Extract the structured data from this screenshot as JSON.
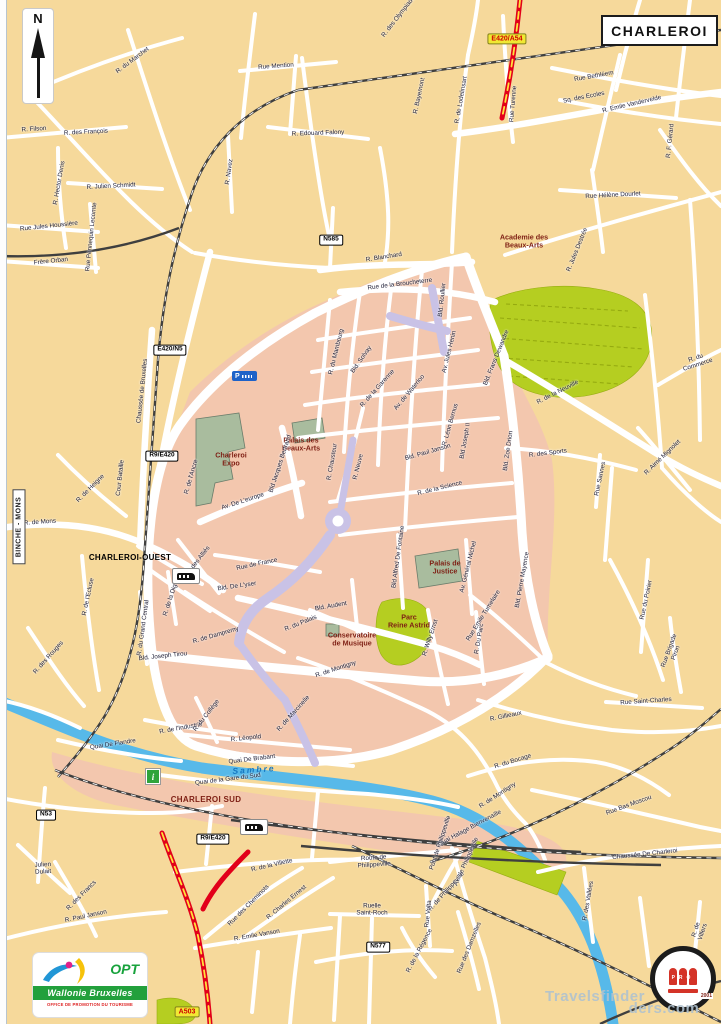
{
  "map": {
    "title": "CHARLEROI",
    "compass": "N",
    "region_tab": "BINCHE - MONS",
    "colors": {
      "land": "#F6D99B",
      "urban": "#F3C7AE",
      "park": "#B5CE21",
      "building": "#A9BC9E",
      "water": "#57B9E9",
      "motorway": "#E2001A",
      "tram": "#C9C2E6",
      "ref_yellow": "#F1E833"
    },
    "icons": {
      "parking": "P",
      "info": "i"
    },
    "labels": [
      {
        "t": "E420/A54",
        "x": 507,
        "y": 39,
        "r": 0,
        "c": "refy"
      },
      {
        "t": "A503",
        "x": 187,
        "y": 1012,
        "r": 0,
        "c": "refy"
      },
      {
        "t": "N585",
        "x": 331,
        "y": 240,
        "r": 0,
        "c": "ref"
      },
      {
        "t": "E420/N5",
        "x": 170,
        "y": 350,
        "r": 0,
        "c": "ref"
      },
      {
        "t": "R9/E420",
        "x": 162,
        "y": 456,
        "r": 0,
        "c": "ref"
      },
      {
        "t": "R9/E420",
        "x": 213,
        "y": 839,
        "r": 0,
        "c": "ref"
      },
      {
        "t": "N53",
        "x": 46,
        "y": 815,
        "r": 0,
        "c": "ref"
      },
      {
        "t": "N577",
        "x": 378,
        "y": 947,
        "r": 0,
        "c": "ref"
      },
      {
        "t": "CHARLEROI-OUEST",
        "x": 130,
        "y": 558,
        "r": 0,
        "c": "sta"
      },
      {
        "t": "CHARLEROI SUD",
        "x": 206,
        "y": 800,
        "r": 0,
        "c": "sta2"
      },
      {
        "t": "Academie des\nBeaux-Arts",
        "x": 524,
        "y": 241,
        "r": 0,
        "c": "poi"
      },
      {
        "t": "Palais des\nBeaux-Arts",
        "x": 301,
        "y": 444,
        "r": 0,
        "c": "poi"
      },
      {
        "t": "Charleroi\nExpo",
        "x": 231,
        "y": 459,
        "r": 0,
        "c": "poi"
      },
      {
        "t": "Palais de\nJustice",
        "x": 445,
        "y": 567,
        "r": 0,
        "c": "poi"
      },
      {
        "t": "Parc\nReine Astrid",
        "x": 409,
        "y": 621,
        "r": 0,
        "c": "poi"
      },
      {
        "t": "Conservatoire\nde Musique",
        "x": 352,
        "y": 639,
        "r": 0,
        "c": "poi"
      },
      {
        "t": "Sambre",
        "x": 254,
        "y": 770,
        "r": -4,
        "c": "river"
      },
      {
        "t": "Travelsfinder",
        "x": 595,
        "y": 997,
        "r": 0,
        "c": "wm"
      },
      {
        "t": "ders.com",
        "x": 664,
        "y": 1009,
        "r": 0,
        "c": "wm"
      },
      {
        "t": "R. des Olympiades",
        "x": 400,
        "y": 16,
        "r": -52,
        "c": "st"
      },
      {
        "t": "R. de Lodelinsart",
        "x": 462,
        "y": 100,
        "r": -80,
        "c": "st"
      },
      {
        "t": "Rue Turenne",
        "x": 514,
        "y": 104,
        "r": -85,
        "c": "st"
      },
      {
        "t": "R. Bayemont",
        "x": 420,
        "y": 96,
        "r": -78,
        "c": "st"
      },
      {
        "t": "Rue Mention",
        "x": 276,
        "y": 67,
        "r": -4,
        "c": "st"
      },
      {
        "t": "R. du Marchet",
        "x": 133,
        "y": 61,
        "r": -37,
        "c": "st"
      },
      {
        "t": "R. Edouard Falony",
        "x": 318,
        "y": 134,
        "r": -2,
        "c": "st"
      },
      {
        "t": "R. Navez",
        "x": 230,
        "y": 172,
        "r": -82,
        "c": "st"
      },
      {
        "t": "Rue Bethléem",
        "x": 594,
        "y": 77,
        "r": -10,
        "c": "st"
      },
      {
        "t": "R. Emile Vandervelde",
        "x": 632,
        "y": 105,
        "r": -13,
        "c": "st"
      },
      {
        "t": "Sq. des Ecoles",
        "x": 584,
        "y": 98,
        "r": -11,
        "c": "st"
      },
      {
        "t": "R. Filson",
        "x": 34,
        "y": 130,
        "r": -4,
        "c": "st"
      },
      {
        "t": "R. des François",
        "x": 86,
        "y": 133,
        "r": -3,
        "c": "st"
      },
      {
        "t": "R. Hector Denis",
        "x": 60,
        "y": 183,
        "r": -80,
        "c": "st"
      },
      {
        "t": "R. Julien Schmidt",
        "x": 111,
        "y": 187,
        "r": -3,
        "c": "st"
      },
      {
        "t": "Rue Jules Houssière",
        "x": 49,
        "y": 227,
        "r": -6,
        "c": "st"
      },
      {
        "t": "Frère Orban",
        "x": 51,
        "y": 262,
        "r": -6,
        "c": "st"
      },
      {
        "t": "Rue Pennequin Lecomte",
        "x": 92,
        "y": 237,
        "r": -84,
        "c": "st"
      },
      {
        "t": "Rue Hélène Dourlet",
        "x": 613,
        "y": 196,
        "r": -3,
        "c": "st"
      },
      {
        "t": "R. F. Gérard",
        "x": 671,
        "y": 141,
        "r": -84,
        "c": "st"
      },
      {
        "t": "R. Jules Destrée",
        "x": 578,
        "y": 250,
        "r": -68,
        "c": "st"
      },
      {
        "t": "R. Blanchard",
        "x": 384,
        "y": 258,
        "r": -9,
        "c": "st"
      },
      {
        "t": "Rue de la Broucheterre",
        "x": 400,
        "y": 285,
        "r": -7,
        "c": "st"
      },
      {
        "t": "Bld. Roullier",
        "x": 443,
        "y": 300,
        "r": -84,
        "c": "st"
      },
      {
        "t": "R. du Mambourg",
        "x": 337,
        "y": 352,
        "r": -76,
        "c": "st"
      },
      {
        "t": "Bld. Solvay",
        "x": 362,
        "y": 360,
        "r": -55,
        "c": "st"
      },
      {
        "t": "R. de la Garenne",
        "x": 378,
        "y": 389,
        "r": -48,
        "c": "st"
      },
      {
        "t": "Av. de Waterloo",
        "x": 410,
        "y": 393,
        "r": -50,
        "c": "st"
      },
      {
        "t": "Av. Jules Henin",
        "x": 450,
        "y": 352,
        "r": -76,
        "c": "st"
      },
      {
        "t": "Bld. Frans Dewandre",
        "x": 497,
        "y": 358,
        "r": -68,
        "c": "st"
      },
      {
        "t": "Bld. Zoe Drion",
        "x": 509,
        "y": 451,
        "r": -82,
        "c": "st"
      },
      {
        "t": "R. Léon Bernus",
        "x": 451,
        "y": 425,
        "r": -74,
        "c": "st"
      },
      {
        "t": "Bld. Paul Janson",
        "x": 428,
        "y": 453,
        "r": -16,
        "c": "st"
      },
      {
        "t": "Bld Joseph II",
        "x": 466,
        "y": 441,
        "r": -80,
        "c": "st"
      },
      {
        "t": "R. de la Science",
        "x": 440,
        "y": 489,
        "r": -14,
        "c": "st"
      },
      {
        "t": "Chaussée de Bruxelles",
        "x": 143,
        "y": 391,
        "r": -84,
        "c": "st"
      },
      {
        "t": "R. de Heigne",
        "x": 91,
        "y": 489,
        "r": -45,
        "c": "st"
      },
      {
        "t": "R. de Mons",
        "x": 40,
        "y": 523,
        "r": -4,
        "c": "st"
      },
      {
        "t": "Cour Bataille",
        "x": 121,
        "y": 478,
        "r": -84,
        "c": "st"
      },
      {
        "t": "R. de l'Ecluse",
        "x": 89,
        "y": 597,
        "r": -78,
        "c": "st"
      },
      {
        "t": "Av. des Alliés",
        "x": 198,
        "y": 562,
        "r": -52,
        "c": "st"
      },
      {
        "t": "R. de la Digue",
        "x": 172,
        "y": 597,
        "r": -72,
        "c": "st"
      },
      {
        "t": "R. du Grand Central",
        "x": 144,
        "y": 628,
        "r": -82,
        "c": "st"
      },
      {
        "t": "Rue de France",
        "x": 257,
        "y": 565,
        "r": -12,
        "c": "st"
      },
      {
        "t": "Bld. De L'yser",
        "x": 237,
        "y": 587,
        "r": -8,
        "c": "st"
      },
      {
        "t": "R. de Dampremy",
        "x": 216,
        "y": 636,
        "r": -16,
        "c": "st"
      },
      {
        "t": "Bld. Joseph Tirou",
        "x": 163,
        "y": 657,
        "r": -6,
        "c": "st"
      },
      {
        "t": "Bld. Audent",
        "x": 331,
        "y": 607,
        "r": -10,
        "c": "st"
      },
      {
        "t": "R. du Palais",
        "x": 301,
        "y": 624,
        "r": -22,
        "c": "st"
      },
      {
        "t": "R. de Montigny",
        "x": 336,
        "y": 670,
        "r": -18,
        "c": "st"
      },
      {
        "t": "R. de Montigny",
        "x": 498,
        "y": 796,
        "r": -33,
        "c": "st"
      },
      {
        "t": "Av. De L'europe",
        "x": 243,
        "y": 502,
        "r": -18,
        "c": "st"
      },
      {
        "t": "Bld Jacques Bertrand",
        "x": 281,
        "y": 464,
        "r": -72,
        "c": "st"
      },
      {
        "t": "R. de l'Ancre",
        "x": 192,
        "y": 477,
        "r": -74,
        "c": "st"
      },
      {
        "t": "R. Chausteur",
        "x": 333,
        "y": 462,
        "r": -80,
        "c": "st"
      },
      {
        "t": "R. Neuve",
        "x": 359,
        "y": 467,
        "r": -76,
        "c": "st"
      },
      {
        "t": "Bld Alfred De Fontaine",
        "x": 399,
        "y": 557,
        "r": -82,
        "c": "st"
      },
      {
        "t": "Av. Général Michel",
        "x": 469,
        "y": 567,
        "r": -76,
        "c": "st"
      },
      {
        "t": "Rue Emile Tumelaire",
        "x": 484,
        "y": 616,
        "r": -58,
        "c": "st"
      },
      {
        "t": "R. Willy Ernst",
        "x": 431,
        "y": 638,
        "r": -72,
        "c": "st"
      },
      {
        "t": "R. Du Parc",
        "x": 480,
        "y": 639,
        "r": -80,
        "c": "st"
      },
      {
        "t": "Bld. Pierre Mayence",
        "x": 523,
        "y": 580,
        "r": -80,
        "c": "st"
      },
      {
        "t": "R. de la Neuville",
        "x": 558,
        "y": 393,
        "r": -27,
        "c": "st"
      },
      {
        "t": "R. des Sports",
        "x": 548,
        "y": 454,
        "r": -7,
        "c": "st"
      },
      {
        "t": "R. Aimé Mignolet",
        "x": 663,
        "y": 458,
        "r": -44,
        "c": "st"
      },
      {
        "t": "R. du Commerce",
        "x": 697,
        "y": 362,
        "r": -18,
        "c": "st"
      },
      {
        "t": "Rue Sannes",
        "x": 601,
        "y": 479,
        "r": -78,
        "c": "st"
      },
      {
        "t": "R. Gillieaux",
        "x": 506,
        "y": 717,
        "r": -12,
        "c": "st"
      },
      {
        "t": "Rue Saint-Charles",
        "x": 646,
        "y": 702,
        "r": -4,
        "c": "st"
      },
      {
        "t": "Rue Brigade Piron",
        "x": 673,
        "y": 652,
        "r": -70,
        "c": "st"
      },
      {
        "t": "Rue du Poirier",
        "x": 647,
        "y": 600,
        "r": -78,
        "c": "st"
      },
      {
        "t": "R. Léopold",
        "x": 246,
        "y": 739,
        "r": -6,
        "c": "st"
      },
      {
        "t": "R. de l'Industrie",
        "x": 181,
        "y": 729,
        "r": -10,
        "c": "st"
      },
      {
        "t": "R. du Collège",
        "x": 207,
        "y": 716,
        "r": -52,
        "c": "st"
      },
      {
        "t": "R. de Marcinelle",
        "x": 294,
        "y": 714,
        "r": -48,
        "c": "st"
      },
      {
        "t": "Quai De Flandre",
        "x": 113,
        "y": 745,
        "r": -9,
        "c": "st"
      },
      {
        "t": "Quai De Brabant",
        "x": 252,
        "y": 760,
        "r": -7,
        "c": "st"
      },
      {
        "t": "Quai de la Gare du Sud",
        "x": 228,
        "y": 780,
        "r": -7,
        "c": "st"
      },
      {
        "t": "R. du Bocage",
        "x": 513,
        "y": 762,
        "r": -17,
        "c": "st"
      },
      {
        "t": "Rue Bas Moscou",
        "x": 629,
        "y": 806,
        "r": -20,
        "c": "st"
      },
      {
        "t": "Chaussée De Charleroi",
        "x": 645,
        "y": 855,
        "r": -6,
        "c": "st"
      },
      {
        "t": "Quai Halage Bienvenaille",
        "x": 470,
        "y": 829,
        "r": -28,
        "c": "st"
      },
      {
        "t": "Pont de Philippeville",
        "x": 441,
        "y": 843,
        "r": -72,
        "c": "st"
      },
      {
        "t": "R. de la Villette",
        "x": 272,
        "y": 866,
        "r": -13,
        "c": "st"
      },
      {
        "t": "Rue des Cheminots",
        "x": 249,
        "y": 906,
        "r": -45,
        "c": "st"
      },
      {
        "t": "R. Charles Ernest",
        "x": 287,
        "y": 903,
        "r": -40,
        "c": "st"
      },
      {
        "t": "R. Emile Vanson",
        "x": 257,
        "y": 936,
        "r": -10,
        "c": "st"
      },
      {
        "t": "R. Paul Janson",
        "x": 86,
        "y": 917,
        "r": -12,
        "c": "st"
      },
      {
        "t": "Julien\nDulait",
        "x": 43,
        "y": 869,
        "r": -3,
        "c": "st"
      },
      {
        "t": "R. des Francs",
        "x": 82,
        "y": 896,
        "r": -45,
        "c": "st"
      },
      {
        "t": "Route de\nPhilippeville",
        "x": 374,
        "y": 862,
        "r": -4,
        "c": "st"
      },
      {
        "t": "Av. de Philippeville",
        "x": 467,
        "y": 862,
        "r": -66,
        "c": "st"
      },
      {
        "t": "R. de Philippeville",
        "x": 447,
        "y": 892,
        "r": -48,
        "c": "st"
      },
      {
        "t": "Rue Volta",
        "x": 429,
        "y": 914,
        "r": -84,
        "c": "st"
      },
      {
        "t": "R. de la Régence",
        "x": 420,
        "y": 951,
        "r": -62,
        "c": "st"
      },
      {
        "t": "Rue des Damzelles",
        "x": 470,
        "y": 948,
        "r": -68,
        "c": "st"
      },
      {
        "t": "Ruelle\nSaint-Roch",
        "x": 372,
        "y": 910,
        "r": 0,
        "c": "st"
      },
      {
        "t": "R. des Vallées",
        "x": 589,
        "y": 901,
        "r": -80,
        "c": "st"
      },
      {
        "t": "R. de Villers",
        "x": 700,
        "y": 931,
        "r": -72,
        "c": "st"
      },
      {
        "t": "R. des Rouges",
        "x": 49,
        "y": 658,
        "r": -48,
        "c": "st"
      }
    ]
  },
  "logos": {
    "opt": {
      "acronym": "OPT",
      "region": "Wallonie Bruxelles",
      "caption": "OFFICE DE PROMOTION DU TOURISME"
    },
    "seal": {
      "letters": "PRO",
      "year": "2001"
    }
  }
}
